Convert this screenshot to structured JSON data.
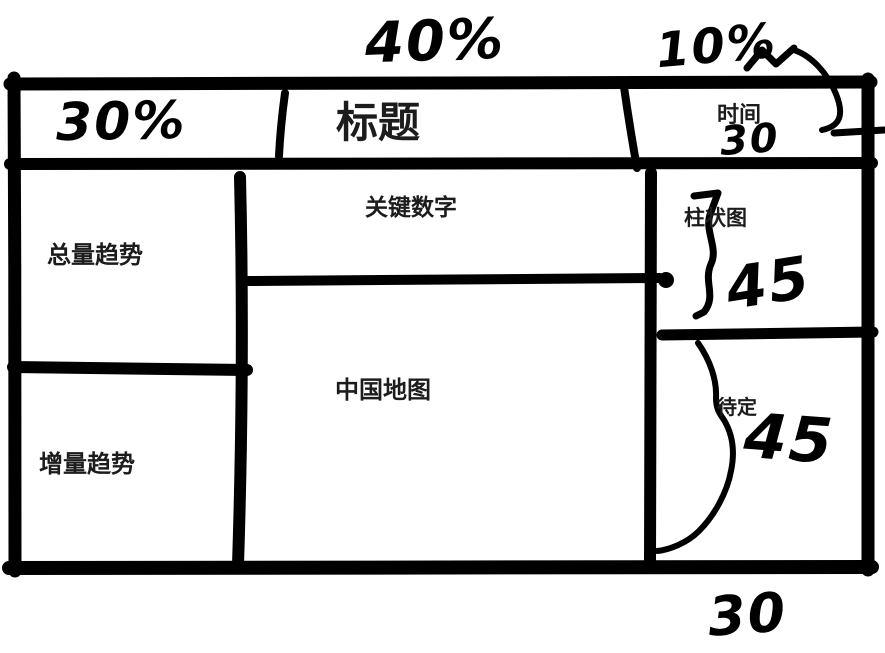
{
  "wireframe": {
    "header": {
      "width_note_left": "30%",
      "width_note_center": "40%",
      "width_note_right": "10%",
      "title": "标题",
      "time_label": "时间",
      "time_height_note": "30"
    },
    "panels": {
      "total_trend": "总量趋势",
      "incremental_trend": "增量趋势",
      "key_numbers": "关键数字",
      "china_map": "中国地图",
      "bar_chart": "柱状图",
      "pending": "待定"
    },
    "height_notes": {
      "bar_chart": "45",
      "pending": "45",
      "bottom": "30"
    },
    "ink_color": "#000000"
  }
}
